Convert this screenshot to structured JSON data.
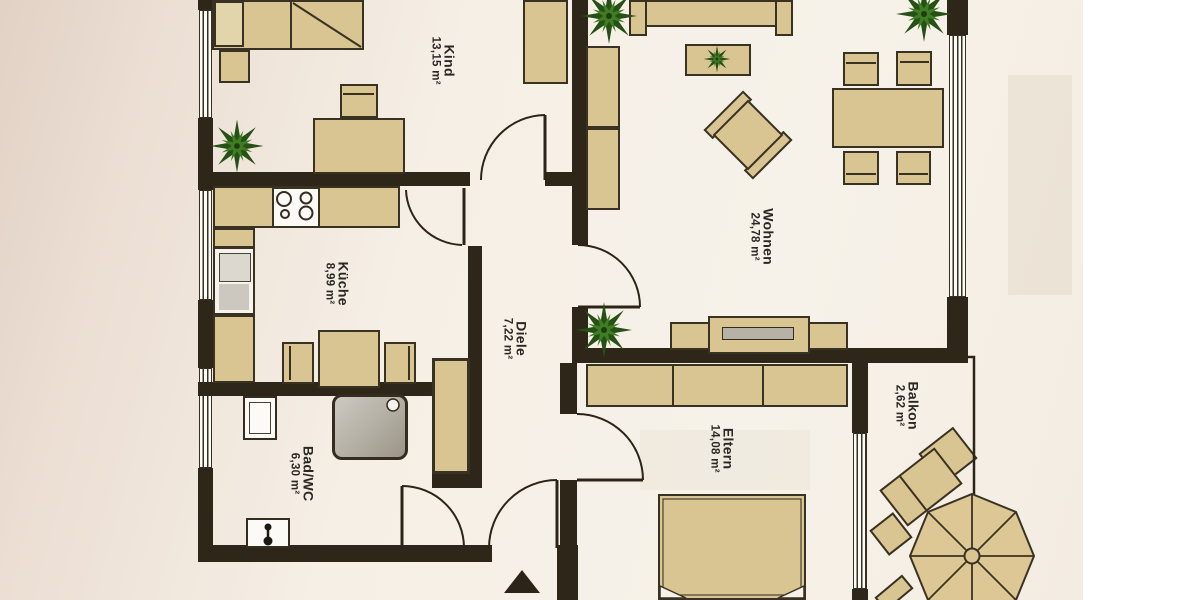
{
  "plan": {
    "rooms": [
      {
        "name": "Kind",
        "area": "13,15 m²"
      },
      {
        "name": "Küche",
        "area": "8,99 m²"
      },
      {
        "name": "Diele",
        "area": "7,22 m²"
      },
      {
        "name": "Bad/WC",
        "area": "6,30 m²"
      },
      {
        "name": "Wohnen",
        "area": "24,78 m²"
      },
      {
        "name": "Eltern",
        "area": "14,08 m²"
      },
      {
        "name": "Balkon",
        "area": "2,62 m²"
      }
    ],
    "colors": {
      "wall": "#2e2719",
      "furniture": "#d8c591",
      "furniture_light": "#e3d5ab",
      "paper": "#f7f2e9",
      "paper_tint": "#e2d1c5",
      "plant_dark": "#265016",
      "plant_light": "#3f7d23",
      "shower_gray": "#b3aea3"
    }
  }
}
